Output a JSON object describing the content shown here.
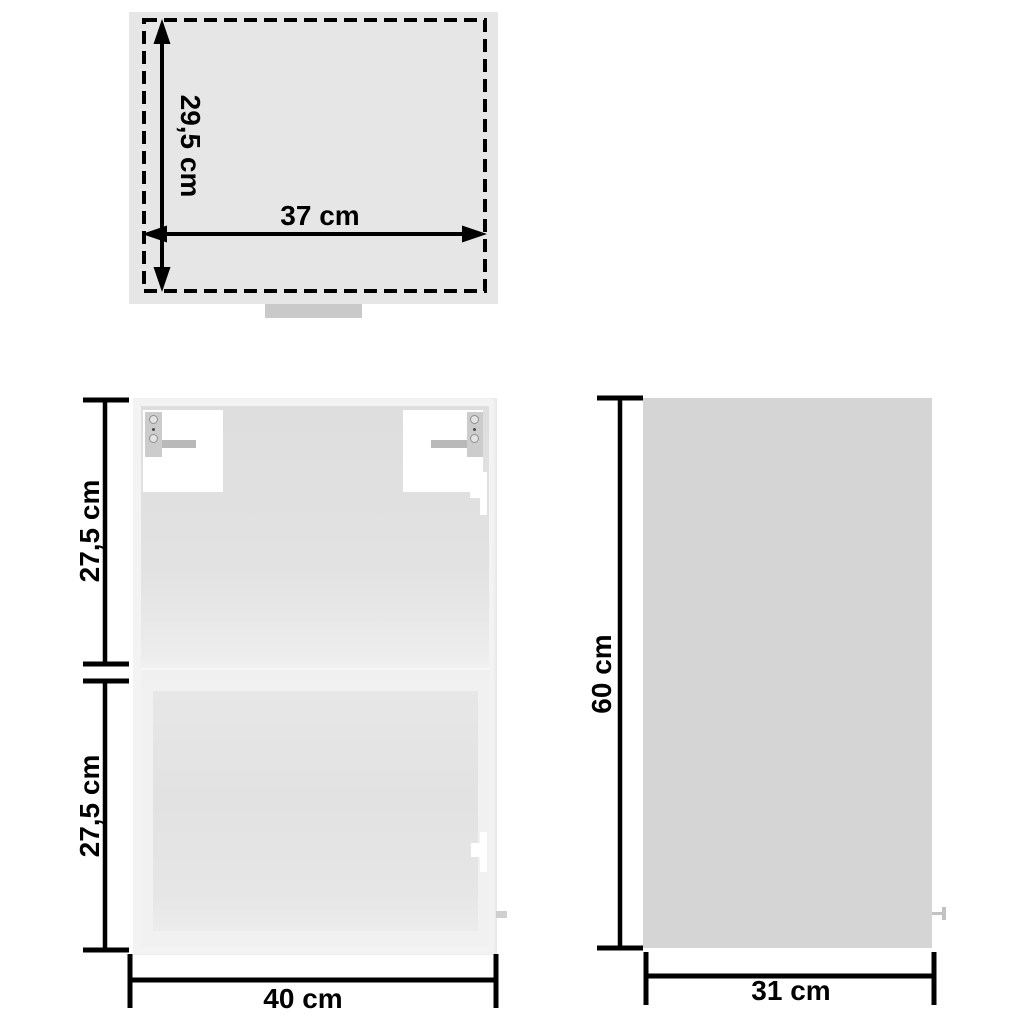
{
  "diagram": {
    "type": "furniture-dimension-diagram",
    "views": {
      "top": {
        "name": "top view",
        "depth_label": "29,5 cm",
        "width_label": "37 cm"
      },
      "front": {
        "name": "front view",
        "upper_section_label": "27,5 cm",
        "lower_section_label": "27,5 cm",
        "width_label": "40 cm"
      },
      "side": {
        "name": "side view",
        "height_label": "60 cm",
        "depth_label": "31 cm"
      }
    },
    "colors": {
      "background": "#ffffff",
      "dimension_lines_and_text": "#000000",
      "top_panel_fill": "#e6e6e6",
      "front_frame_fill": "#f3f3f3",
      "front_interior_fill": "#e2e2e2",
      "lower_glass_fill": "#e4e4e4",
      "side_panel_fill": "#d5d5d5",
      "bracket_fill": "#ffffff",
      "hardware_fill": "#c9c9c9"
    }
  }
}
